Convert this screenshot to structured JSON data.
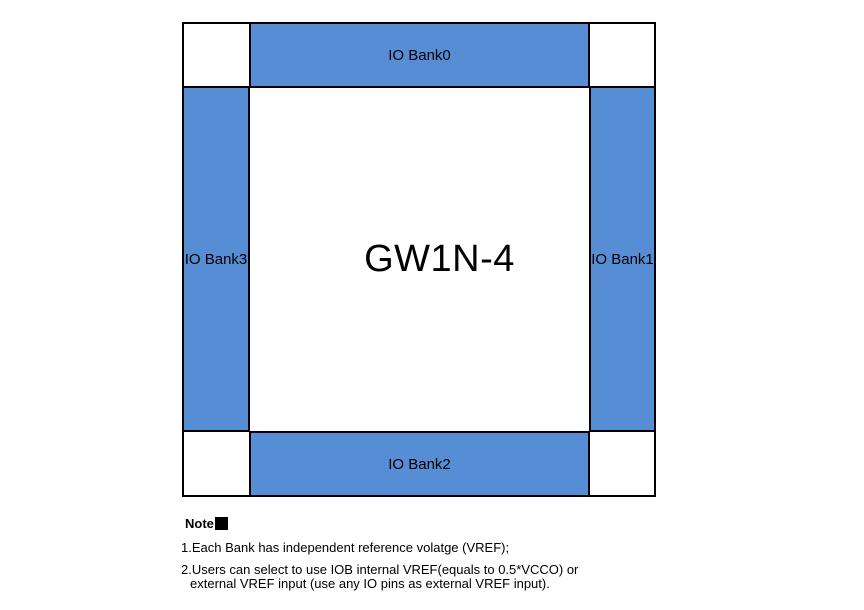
{
  "diagram": {
    "chip_label": "GW1N-4",
    "banks": {
      "top": {
        "label": "IO Bank0"
      },
      "right": {
        "label": "IO Bank1"
      },
      "bottom": {
        "label": "IO Bank2"
      },
      "left": {
        "label": "IO Bank3"
      }
    }
  },
  "notes": {
    "heading": "Note",
    "items": [
      {
        "lines": [
          "1.Each Bank has independent reference volatge (VREF);"
        ]
      },
      {
        "lines": [
          "2.Users can select to use IOB internal VREF(equals to 0.5*VCCO) or",
          "external VREF input (use any IO pins as external VREF input)."
        ]
      }
    ]
  },
  "colors": {
    "bank_fill": "#578DD5",
    "border": "#000000",
    "text": "#000000"
  }
}
